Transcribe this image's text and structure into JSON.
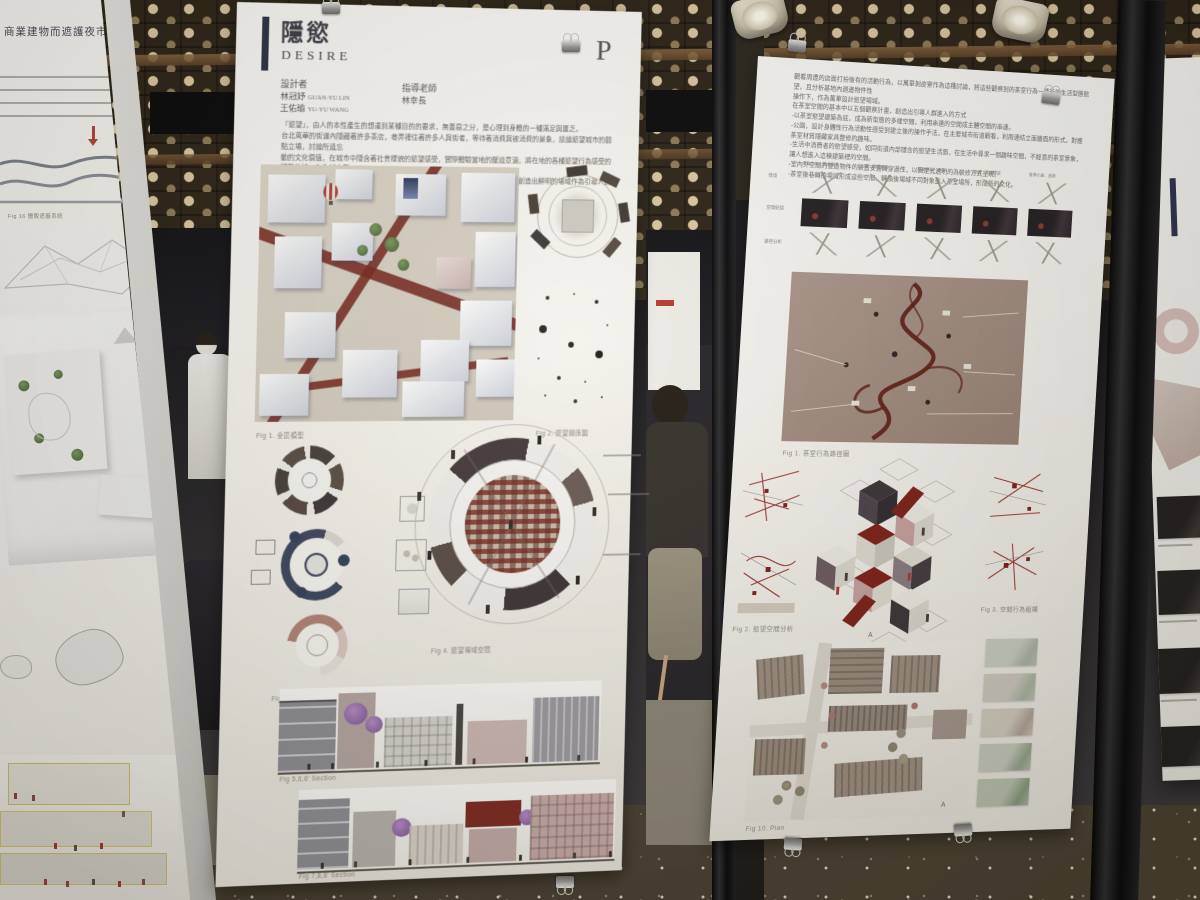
{
  "scene": {
    "setting": "architecture exhibition poster boards on black metal frames",
    "colors": {
      "poster_white": "#f7f5f0",
      "navy_accent": "#2e3450",
      "street_red": "#76281f",
      "mauve_panel": "#a18a7f",
      "ceiling_dot": "#dcc9a2",
      "floor": "#4a4233"
    }
  },
  "left_poster": {
    "title_partial": "商業建物而遮護夜市人",
    "fig_caption": "Fig 16 攤販遮蔽系統"
  },
  "center_poster": {
    "title_zh": "隱慾",
    "title_en": "DESIRE",
    "page_letter": "P",
    "designer_label": "設計者",
    "designers": [
      {
        "zh": "林冠妤",
        "en": "GUAN-YU LIN"
      },
      {
        "zh": "王佑瑜",
        "en": "YU-YU WANG"
      }
    ],
    "advisor_label": "指導老師",
    "advisor": "林幸長",
    "abstract_lines": [
      "「慾望」，由人的本性產生的想達到某種目的的要求，無善惡之分，是心理到身體的一種滿足與匱乏。",
      "台北萬華的街道內隱藏著許多茶店，巷弄裡住著許多人與街者，等待著消費與被消費的景象，談論慾望城市的觀點立場，討論所遺忘",
      "動的文化價值，在城市中隱含著社會樣貌的慾望感受，實際體驗當地的壓迫意涵，將在地的各種慾望行為感受的類型分析，作為城市發",
      "展的計畫，以臨時建築的方式去觀察這個特殊的場域，形成一種新的生活型態，創造出鮮明的場域作為引導人群進入的方式。"
    ],
    "fig_captions": {
      "fig1": "Fig 1. 全區模型",
      "fig2": "Fig 2. 慾望關係圖",
      "fig3": "Fig 3. 慾望場域",
      "fig4": "Fig 4. 慾望場域空間",
      "fig5": "Fig 5,6,6' Section",
      "fig6": "Fig 7,8,8' Section"
    }
  },
  "right_poster": {
    "intro_lines": [
      "觀看周遭的店面打扮後有的活動行為，以萬華剝皮寮作為這種討論，將這些觀察到的茶室行為一種新的生活型態慾望，且分析基地內週邊物件性",
      "操作下，作為萬華設計慾望場域。",
      "在茶室空間的基本中以五個觀察計畫，創造出引導人群進入的方式",
      "-以茶室慾望建築為底，成為新型態的多樣空間，利用串連的空間成主體空間的串連。",
      "-公園，設計身體性行為活動性感受到建立後的操作手法，在主要城市街道觀看，利用連結立面牆面的形式，對應茶室材質隱藏家具整修的趣味。",
      "-生活中消費者的慾望感受，如同街道內部隱含的慾望生活面，在生活中尋求一個趣味空間，不經意的茶室景象，讓人想進入這棟建築裡的空間。",
      "-室內外空間的營造物件的裝置安置與穿過性，以固定式透明的為裝修方式呈現。",
      "-茶室後巷轉換場域形成這些空間，轉換後場域不同對象進入茶室場所，形成新的文化。"
    ],
    "matrix": {
      "row_labels": [
        "情境",
        "空間紀錄",
        "路徑分析"
      ],
      "col_headers": [
        "不良少年．舞女觀看",
        "大廳．觀看簾幕",
        "樓梯轉角．偷看",
        "房間．慾望釋放",
        "後巷小路．逃跑"
      ]
    },
    "section_marker": "A",
    "fig_captions": {
      "fig1": "Fig 1. 茶室行為路徑圖",
      "fig2": "Fig 2. 慾望空間分析",
      "fig3": "Fig 3. 空間行為組構",
      "fig4": "Fig 10. Plan"
    }
  }
}
